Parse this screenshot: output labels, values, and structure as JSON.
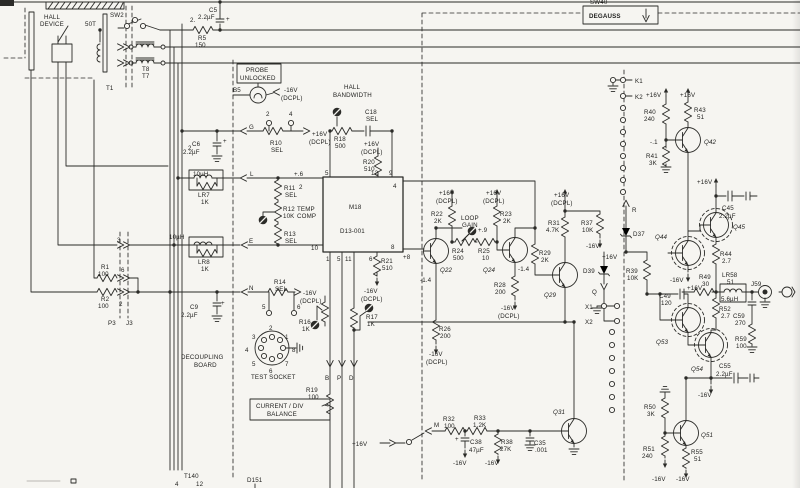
{
  "colors": {
    "ink": "#2b2b28",
    "paper": "#f6f5f1"
  },
  "labels": [
    {
      "n": "hall-device-1",
      "t": "HALL",
      "x": 44,
      "y": 19
    },
    {
      "n": "hall-device-2",
      "t": "DEVICE",
      "x": 40,
      "y": 26
    },
    {
      "n": "winding-50t",
      "t": "50T",
      "x": 85,
      "y": 26
    },
    {
      "n": "sw2",
      "t": "SW2",
      "x": 110,
      "y": 17
    },
    {
      "n": "t1",
      "t": "T1",
      "x": 106,
      "y": 90
    },
    {
      "n": "t8",
      "t": "T8",
      "x": 142,
      "y": 71
    },
    {
      "n": "t7",
      "t": "T7",
      "x": 142,
      "y": 78
    },
    {
      "n": "wire-2a",
      "t": "2.",
      "x": 190,
      "y": 22
    },
    {
      "n": "wire-2b",
      "t": "2.",
      "x": 188,
      "y": 150
    },
    {
      "n": "c5",
      "t": "C5",
      "x": 209,
      "y": 12
    },
    {
      "n": "c5-val",
      "t": "2.2µF",
      "x": 198,
      "y": 19
    },
    {
      "n": "c5-plus",
      "t": "+",
      "x": 226,
      "y": 21,
      "f": 7
    },
    {
      "n": "r5",
      "t": "R5",
      "x": 198,
      "y": 40
    },
    {
      "n": "r5-val",
      "t": "150",
      "x": 195,
      "y": 47
    },
    {
      "n": "probe",
      "t": "PROBE",
      "x": 246,
      "y": 72,
      "f": 5.6
    },
    {
      "n": "unlocked",
      "t": "UNLOCKED",
      "x": 240,
      "y": 80,
      "f": 5.6
    },
    {
      "n": "b5",
      "t": "B5",
      "x": 233,
      "y": 92
    },
    {
      "n": "neg16-lamp",
      "t": "-16V",
      "x": 284,
      "y": 92
    },
    {
      "n": "neg16-lamp-d",
      "t": "(DCPL)",
      "x": 281,
      "y": 100
    },
    {
      "n": "hall-bw-1",
      "t": "HALL",
      "x": 344,
      "y": 89
    },
    {
      "n": "hall-bw-2",
      "t": "BANDWIDTH",
      "x": 333,
      "y": 97
    },
    {
      "n": "r18",
      "t": "R18",
      "x": 334,
      "y": 141
    },
    {
      "n": "r18-val",
      "t": "500",
      "x": 335,
      "y": 148
    },
    {
      "n": "c18",
      "t": "C18",
      "x": 365,
      "y": 114
    },
    {
      "n": "c18-val",
      "t": "SEL",
      "x": 366,
      "y": 121
    },
    {
      "n": "p16-r20",
      "t": "+16V",
      "x": 364,
      "y": 146
    },
    {
      "n": "p16-r20-d",
      "t": "(DCPL)",
      "x": 361,
      "y": 154
    },
    {
      "n": "r20",
      "t": "R20",
      "x": 363,
      "y": 164
    },
    {
      "n": "r20-val",
      "t": "510",
      "x": 364,
      "y": 171
    },
    {
      "n": "term-g",
      "t": "G",
      "x": 249,
      "y": 129
    },
    {
      "n": "r10",
      "t": "R10",
      "x": 270,
      "y": 145
    },
    {
      "n": "r10-val",
      "t": "SEL",
      "x": 271,
      "y": 152
    },
    {
      "n": "pin2",
      "t": "2",
      "x": 266,
      "y": 116
    },
    {
      "n": "pin4",
      "t": "4",
      "x": 289,
      "y": 116
    },
    {
      "n": "p16-r10",
      "t": "+16V",
      "x": 312,
      "y": 136
    },
    {
      "n": "p16-r10-d",
      "t": "(DCPL)",
      "x": 309,
      "y": 144
    },
    {
      "n": "c6",
      "t": "C6",
      "x": 192,
      "y": 146
    },
    {
      "n": "c6-val",
      "t": "2.2µF",
      "x": 183,
      "y": 154
    },
    {
      "n": "c6-plus",
      "t": "+",
      "x": 223,
      "y": 143,
      "f": 7
    },
    {
      "n": "lr7-uh",
      "t": "10µH",
      "x": 193,
      "y": 176,
      "f": 5.4
    },
    {
      "n": "lr7",
      "t": "LR7",
      "x": 198,
      "y": 197
    },
    {
      "n": "lr7-val",
      "t": "1K",
      "x": 201,
      "y": 204
    },
    {
      "n": "term-l",
      "t": "L",
      "x": 250,
      "y": 176
    },
    {
      "n": "r11",
      "t": "R11",
      "x": 284,
      "y": 190
    },
    {
      "n": "r11-val",
      "t": "SEL",
      "x": 285,
      "y": 197
    },
    {
      "n": "r12",
      "t": "R12",
      "x": 283,
      "y": 211
    },
    {
      "n": "r12-b",
      "t": "TEMP",
      "x": 297,
      "y": 211
    },
    {
      "n": "r12-val",
      "t": "10K",
      "x": 283,
      "y": 218
    },
    {
      "n": "r12-c",
      "t": "COMP",
      "x": 297,
      "y": 218
    },
    {
      "n": "r13",
      "t": "R13",
      "x": 284,
      "y": 236
    },
    {
      "n": "r13-val",
      "t": "SEL",
      "x": 285,
      "y": 243
    },
    {
      "n": "term-e",
      "t": "E",
      "x": 249,
      "y": 243
    },
    {
      "n": "lr8-uh",
      "t": "10µH",
      "x": 169,
      "y": 239
    },
    {
      "n": "lr8",
      "t": "LR8",
      "x": 198,
      "y": 264
    },
    {
      "n": "lr8-val",
      "t": "1K",
      "x": 201,
      "y": 271
    },
    {
      "n": "term-n",
      "t": "N",
      "x": 249,
      "y": 290
    },
    {
      "n": "r14",
      "t": "R14",
      "x": 274,
      "y": 284
    },
    {
      "n": "r14-val",
      "t": "SEL",
      "x": 275,
      "y": 291
    },
    {
      "n": "m16-r14",
      "t": "-16V",
      "x": 303,
      "y": 295
    },
    {
      "n": "m16-r14-d",
      "t": "(DCPL)",
      "x": 300,
      "y": 303
    },
    {
      "n": "pin5",
      "t": "5",
      "x": 262,
      "y": 309
    },
    {
      "n": "pin6",
      "t": "6",
      "x": 297,
      "y": 309
    },
    {
      "n": "c9",
      "t": "C9",
      "x": 190,
      "y": 309
    },
    {
      "n": "c9-val",
      "t": "2.2µF",
      "x": 181,
      "y": 317
    },
    {
      "n": "c9-plus",
      "t": "+",
      "x": 221,
      "y": 305,
      "f": 7
    },
    {
      "n": "decoupling",
      "t": "DECOUPLING",
      "x": 181,
      "y": 359
    },
    {
      "n": "board",
      "t": "BOARD",
      "x": 194,
      "y": 367
    },
    {
      "n": "ts-2",
      "t": "2",
      "x": 269,
      "y": 330
    },
    {
      "n": "ts-1",
      "t": "1",
      "x": 285,
      "y": 339
    },
    {
      "n": "ts-8",
      "t": "8",
      "x": 292,
      "y": 352
    },
    {
      "n": "ts-7",
      "t": "7",
      "x": 285,
      "y": 366
    },
    {
      "n": "ts-6",
      "t": "6",
      "x": 269,
      "y": 373
    },
    {
      "n": "ts-5",
      "t": "5",
      "x": 252,
      "y": 366
    },
    {
      "n": "ts-4",
      "t": "4",
      "x": 245,
      "y": 352
    },
    {
      "n": "ts-3",
      "t": "3",
      "x": 252,
      "y": 339
    },
    {
      "n": "test-socket",
      "t": "TEST SOCKET",
      "x": 251,
      "y": 379
    },
    {
      "n": "r19",
      "t": "R19",
      "x": 306,
      "y": 392
    },
    {
      "n": "r19-val",
      "t": "100",
      "x": 308,
      "y": 399
    },
    {
      "n": "current-div",
      "t": "CURRENT / DIV",
      "x": 256,
      "y": 408,
      "f": 5.8
    },
    {
      "n": "balance",
      "t": "BALANCE",
      "x": 267,
      "y": 416,
      "f": 5.8
    },
    {
      "n": "r16",
      "t": "R16",
      "x": 299,
      "y": 324
    },
    {
      "n": "r16-val",
      "t": "1K",
      "x": 302,
      "y": 331
    },
    {
      "n": "r17",
      "t": "R17",
      "x": 366,
      "y": 319
    },
    {
      "n": "r17-val",
      "t": "1K",
      "x": 367,
      "y": 326
    },
    {
      "n": "term-b",
      "t": "B",
      "x": 325,
      "y": 380
    },
    {
      "n": "term-p",
      "t": "P",
      "x": 337,
      "y": 380
    },
    {
      "n": "term-d",
      "t": "D",
      "x": 349,
      "y": 380
    },
    {
      "n": "t140",
      "t": "T140",
      "x": 184,
      "y": 478
    },
    {
      "n": "t140-4",
      "t": "4",
      "x": 175,
      "y": 486
    },
    {
      "n": "t140-12",
      "t": "12",
      "x": 196,
      "y": 486
    },
    {
      "n": "d151",
      "t": "D151",
      "x": 247,
      "y": 482
    },
    {
      "n": "p16-m",
      "t": "+16V",
      "x": 352,
      "y": 446
    },
    {
      "n": "term-m",
      "t": "M",
      "x": 434,
      "y": 427
    },
    {
      "n": "m18",
      "t": "M18",
      "x": 349,
      "y": 209,
      "f": 8
    },
    {
      "n": "m18-part",
      "t": "D13-001",
      "x": 340,
      "y": 233
    },
    {
      "n": "m18-p5",
      "t": "5",
      "x": 325,
      "y": 175
    },
    {
      "n": "m18-v6",
      "t": "+.6",
      "x": 294,
      "y": 176
    },
    {
      "n": "m18-p2",
      "t": "2",
      "x": 299,
      "y": 189
    },
    {
      "n": "m18-p12",
      "t": "12",
      "x": 371,
      "y": 175
    },
    {
      "n": "m18-p9",
      "t": "9",
      "x": 389,
      "y": 175
    },
    {
      "n": "m18-p4",
      "t": "4",
      "x": 393,
      "y": 188
    },
    {
      "n": "m18-p10",
      "t": "10",
      "x": 311,
      "y": 250
    },
    {
      "n": "m18-p1",
      "t": "1",
      "x": 326,
      "y": 261
    },
    {
      "n": "m18-p5b",
      "t": "5",
      "x": 337,
      "y": 261
    },
    {
      "n": "m18-p11",
      "t": "11",
      "x": 345,
      "y": 261
    },
    {
      "n": "m18-p6",
      "t": "6",
      "x": 369,
      "y": 261
    },
    {
      "n": "m18-p8",
      "t": "8",
      "x": 391,
      "y": 249
    },
    {
      "n": "m18-v8",
      "t": "+8",
      "x": 403,
      "y": 259
    },
    {
      "n": "r21",
      "t": "R21",
      "x": 381,
      "y": 263
    },
    {
      "n": "r21-val",
      "t": "510",
      "x": 382,
      "y": 270
    },
    {
      "n": "m16-r21",
      "t": "-16V",
      "x": 364,
      "y": 293
    },
    {
      "n": "m16-r21-d",
      "t": "(DCPL)",
      "x": 361,
      "y": 301
    },
    {
      "n": "r22",
      "t": "R22",
      "x": 431,
      "y": 216
    },
    {
      "n": "r22-val",
      "t": "2K",
      "x": 434,
      "y": 223
    },
    {
      "n": "p16-r22",
      "t": "+16V",
      "x": 439,
      "y": 195
    },
    {
      "n": "p16-r22-d",
      "t": "(DCPL)",
      "x": 436,
      "y": 203
    },
    {
      "n": "loop",
      "t": "LOOP",
      "x": 461,
      "y": 220
    },
    {
      "n": "gain",
      "t": "GAIN",
      "x": 462,
      "y": 227
    },
    {
      "n": "r24",
      "t": "R24",
      "x": 452,
      "y": 253
    },
    {
      "n": "r24-val",
      "t": "500",
      "x": 453,
      "y": 260
    },
    {
      "n": "r25",
      "t": "R25",
      "x": 478,
      "y": 253
    },
    {
      "n": "r25-val",
      "t": "10",
      "x": 482,
      "y": 260
    },
    {
      "n": "v-p9",
      "t": "+.9",
      "x": 478,
      "y": 232
    },
    {
      "n": "r23",
      "t": "R23",
      "x": 500,
      "y": 216
    },
    {
      "n": "r23-val",
      "t": "2K",
      "x": 503,
      "y": 223
    },
    {
      "n": "p16-r23",
      "t": "+16V",
      "x": 486,
      "y": 195
    },
    {
      "n": "p16-r23-d",
      "t": "(DCPL)",
      "x": 483,
      "y": 203
    },
    {
      "n": "q22",
      "t": "Q22",
      "x": 440,
      "y": 272,
      "f": 7.5,
      "i": 1
    },
    {
      "n": "q24",
      "t": "Q24",
      "x": 483,
      "y": 272,
      "f": 7.5,
      "i": 1
    },
    {
      "n": "v14a",
      "t": "-1.4",
      "x": 420,
      "y": 282
    },
    {
      "n": "v14b",
      "t": "-1.4",
      "x": 518,
      "y": 271
    },
    {
      "n": "r28",
      "t": "R28",
      "x": 494,
      "y": 287
    },
    {
      "n": "r28-val",
      "t": "200",
      "x": 495,
      "y": 294
    },
    {
      "n": "m16-r28",
      "t": "-16V",
      "x": 501,
      "y": 310
    },
    {
      "n": "m16-r28-d",
      "t": "(DCPL)",
      "x": 498,
      "y": 318
    },
    {
      "n": "r26",
      "t": "R26",
      "x": 439,
      "y": 331
    },
    {
      "n": "r26-val",
      "t": "200",
      "x": 440,
      "y": 338
    },
    {
      "n": "m16-r26",
      "t": "-16V",
      "x": 429,
      "y": 356
    },
    {
      "n": "m16-r26-d",
      "t": "(DCPL)",
      "x": 426,
      "y": 364
    },
    {
      "n": "r29",
      "t": "R29",
      "x": 539,
      "y": 255
    },
    {
      "n": "r29-val",
      "t": "2K",
      "x": 541,
      "y": 262
    },
    {
      "n": "q29",
      "t": "Q29",
      "x": 544,
      "y": 297,
      "f": 7.5,
      "i": 1
    },
    {
      "n": "r31",
      "t": "R31",
      "x": 548,
      "y": 225
    },
    {
      "n": "r31-val",
      "t": "4.7K",
      "x": 546,
      "y": 232
    },
    {
      "n": "p16-r31",
      "t": "+16V",
      "x": 554,
      "y": 197
    },
    {
      "n": "p16-r31-d",
      "t": "(DCPL)",
      "x": 551,
      "y": 205
    },
    {
      "n": "r37",
      "t": "R37",
      "x": 581,
      "y": 225
    },
    {
      "n": "r37-val",
      "t": "10K",
      "x": 582,
      "y": 232
    },
    {
      "n": "m16-r37",
      "t": "-16V",
      "x": 586,
      "y": 248
    },
    {
      "n": "d39",
      "t": "D39",
      "x": 583,
      "y": 273
    },
    {
      "n": "term-q",
      "t": "Q",
      "x": 592,
      "y": 294
    },
    {
      "n": "x1",
      "t": "X1",
      "x": 585,
      "y": 309
    },
    {
      "n": "x2",
      "t": "X2",
      "x": 585,
      "y": 324
    },
    {
      "n": "d37",
      "t": "D37",
      "x": 633,
      "y": 236
    },
    {
      "n": "term-r",
      "t": "R",
      "x": 632,
      "y": 212
    },
    {
      "n": "p16-d37",
      "t": "+16V",
      "x": 602,
      "y": 259
    },
    {
      "n": "r39",
      "t": "R39",
      "x": 626,
      "y": 273
    },
    {
      "n": "r39-val",
      "t": "10K",
      "x": 627,
      "y": 280
    },
    {
      "n": "k1",
      "t": "K1",
      "x": 635,
      "y": 83
    },
    {
      "n": "k2",
      "t": "K2",
      "x": 635,
      "y": 99
    },
    {
      "n": "p16-r40",
      "t": "+16V",
      "x": 646,
      "y": 97
    },
    {
      "n": "p16-r43",
      "t": "+16V",
      "x": 680,
      "y": 97
    },
    {
      "n": "r40",
      "t": "R40",
      "x": 644,
      "y": 114
    },
    {
      "n": "r40-val",
      "t": "240",
      "x": 644,
      "y": 121
    },
    {
      "n": "r43",
      "t": "R43",
      "x": 694,
      "y": 112
    },
    {
      "n": "r43-val",
      "t": "51",
      "x": 697,
      "y": 119
    },
    {
      "n": "q42",
      "t": "Q42",
      "x": 704,
      "y": 144,
      "f": 7.5,
      "i": 1
    },
    {
      "n": "r41",
      "t": "R41",
      "x": 646,
      "y": 158
    },
    {
      "n": "r41-val",
      "t": "3K",
      "x": 649,
      "y": 165
    },
    {
      "n": "v-m1",
      "t": "-.1",
      "x": 650,
      "y": 144
    },
    {
      "n": "p16-q45",
      "t": "+16V",
      "x": 697,
      "y": 184
    },
    {
      "n": "c45",
      "t": "C45",
      "x": 722,
      "y": 210
    },
    {
      "n": "c45-val",
      "t": "2.2µF",
      "x": 719,
      "y": 218
    },
    {
      "n": "q45",
      "t": "Q45",
      "x": 733,
      "y": 229,
      "f": 7.5,
      "i": 1
    },
    {
      "n": "q44",
      "t": "Q44",
      "x": 655,
      "y": 239,
      "f": 7.5,
      "i": 1
    },
    {
      "n": "r44",
      "t": "R44",
      "x": 720,
      "y": 256
    },
    {
      "n": "r44-val",
      "t": "2.7",
      "x": 722,
      "y": 263
    },
    {
      "n": "m16-q44",
      "t": "-16V",
      "x": 670,
      "y": 282
    },
    {
      "n": "r49",
      "t": "R49",
      "x": 699,
      "y": 279
    },
    {
      "n": "r49-val",
      "t": "30",
      "x": 702,
      "y": 286
    },
    {
      "n": "lr58",
      "t": "LR58",
      "x": 722,
      "y": 277
    },
    {
      "n": "lr58-val",
      "t": "51",
      "x": 727,
      "y": 284
    },
    {
      "n": "lr58-uh",
      "t": "5.6µH",
      "x": 721,
      "y": 301,
      "f": 5.4
    },
    {
      "n": "j59",
      "t": "J59",
      "x": 751,
      "y": 286
    },
    {
      "n": "r52",
      "t": "R52",
      "x": 719,
      "y": 311
    },
    {
      "n": "r52-val",
      "t": "2.7",
      "x": 721,
      "y": 318
    },
    {
      "n": "c59",
      "t": "C59",
      "x": 733,
      "y": 318
    },
    {
      "n": "c59-val",
      "t": "270",
      "x": 735,
      "y": 325
    },
    {
      "n": "r59",
      "t": "R59",
      "x": 735,
      "y": 341
    },
    {
      "n": "r59-val",
      "t": "100",
      "x": 736,
      "y": 348
    },
    {
      "n": "c49",
      "t": "C49",
      "x": 659,
      "y": 298
    },
    {
      "n": "c49-val",
      "t": "120",
      "x": 661,
      "y": 305
    },
    {
      "n": "p16-c49",
      "t": "+16V",
      "x": 687,
      "y": 290
    },
    {
      "n": "q53",
      "t": "Q53",
      "x": 656,
      "y": 344,
      "f": 7.5,
      "i": 1
    },
    {
      "n": "q54",
      "t": "Q54",
      "x": 691,
      "y": 371,
      "f": 7.5,
      "i": 1
    },
    {
      "n": "c55",
      "t": "C55",
      "x": 719,
      "y": 368
    },
    {
      "n": "c55-val",
      "t": "2.2µF",
      "x": 716,
      "y": 376
    },
    {
      "n": "m16-c55",
      "t": "-16V",
      "x": 698,
      "y": 397
    },
    {
      "n": "r50",
      "t": "R50",
      "x": 644,
      "y": 409
    },
    {
      "n": "r50-val",
      "t": "3K",
      "x": 647,
      "y": 416
    },
    {
      "n": "q51",
      "t": "Q51",
      "x": 701,
      "y": 437,
      "f": 7.5,
      "i": 1
    },
    {
      "n": "r51",
      "t": "R51",
      "x": 643,
      "y": 451
    },
    {
      "n": "r51-val",
      "t": "240",
      "x": 642,
      "y": 458
    },
    {
      "n": "m16-r51",
      "t": "-16V",
      "x": 652,
      "y": 481
    },
    {
      "n": "r55",
      "t": "R55",
      "x": 691,
      "y": 454
    },
    {
      "n": "r55-val",
      "t": "51",
      "x": 694,
      "y": 461
    },
    {
      "n": "m16-r55",
      "t": "-16V",
      "x": 676,
      "y": 481
    },
    {
      "n": "q31",
      "t": "Q31",
      "x": 553,
      "y": 414,
      "f": 7.5,
      "i": 1
    },
    {
      "n": "r32",
      "t": "R32",
      "x": 443,
      "y": 421
    },
    {
      "n": "r32-val",
      "t": "100",
      "x": 444,
      "y": 428
    },
    {
      "n": "r33",
      "t": "R33",
      "x": 474,
      "y": 420
    },
    {
      "n": "r33-val",
      "t": "1.2K",
      "x": 473,
      "y": 427
    },
    {
      "n": "c38",
      "t": "C38",
      "x": 470,
      "y": 444
    },
    {
      "n": "c38-val",
      "t": "47µF",
      "x": 469,
      "y": 452
    },
    {
      "n": "c38-plus",
      "t": "+",
      "x": 455,
      "y": 441,
      "f": 7
    },
    {
      "n": "m16-c38",
      "t": "-16V",
      "x": 453,
      "y": 465
    },
    {
      "n": "r38",
      "t": "R38",
      "x": 501,
      "y": 444
    },
    {
      "n": "r38-val",
      "t": "27K",
      "x": 500,
      "y": 451
    },
    {
      "n": "m16-r38",
      "t": "-16V",
      "x": 485,
      "y": 465
    },
    {
      "n": "c35",
      "t": "C35",
      "x": 534,
      "y": 445
    },
    {
      "n": "c35-val",
      "t": ".001",
      "x": 535,
      "y": 452
    },
    {
      "n": "sw40",
      "t": "SW40",
      "x": 590,
      "y": 4,
      "f": 5.6
    },
    {
      "n": "degauss",
      "t": "DEGAUSS",
      "x": 589,
      "y": 18,
      "f": 6.8,
      "b": 1
    },
    {
      "n": "r1",
      "t": "R1",
      "x": 101,
      "y": 269
    },
    {
      "n": "r1-val",
      "t": "100",
      "x": 98,
      "y": 276
    },
    {
      "n": "r2",
      "t": "R2",
      "x": 101,
      "y": 301
    },
    {
      "n": "r2-val",
      "t": "100",
      "x": 98,
      "y": 308
    },
    {
      "n": "p3",
      "t": "P3",
      "x": 108,
      "y": 325
    },
    {
      "n": "j3",
      "t": "J3",
      "x": 126,
      "y": 325
    },
    {
      "n": "pj-3",
      "t": "3",
      "x": 117,
      "y": 242
    },
    {
      "n": "pj-6",
      "t": "6",
      "x": 121,
      "y": 272
    },
    {
      "n": "pj-2",
      "t": "2",
      "x": 119,
      "y": 306
    }
  ]
}
